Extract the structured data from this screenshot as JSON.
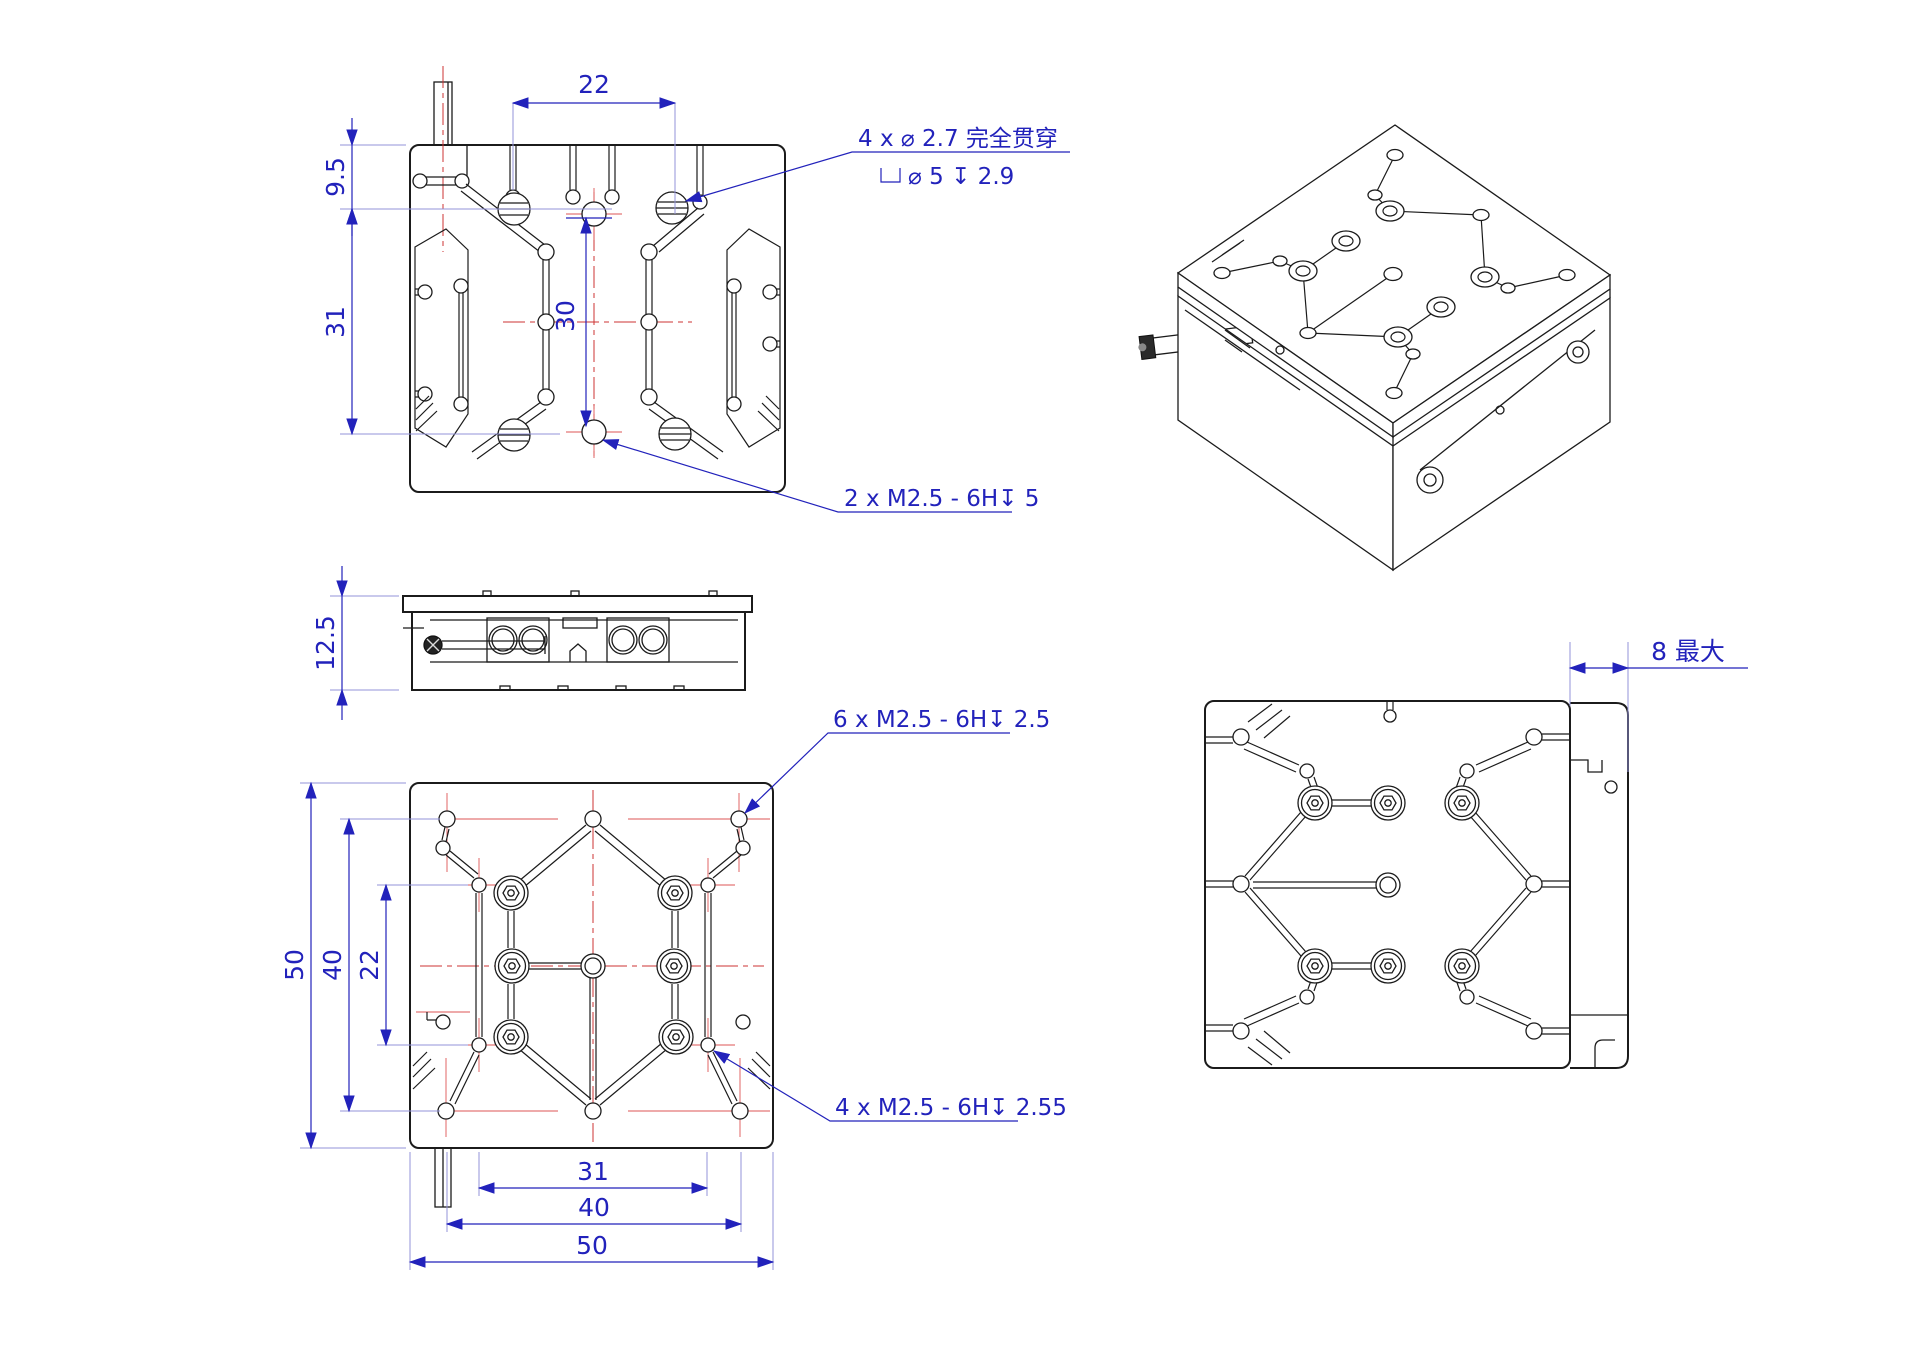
{
  "drawing_type": "engineering-drawing",
  "colors": {
    "background": "#ffffff",
    "line": "#1b1b1b",
    "dimension": "#2222bb",
    "centerline": "#cc3333"
  },
  "icons": {
    "counterbore": "⌴",
    "depth": "↧",
    "diameter": "⌀"
  },
  "views": {
    "top": {
      "dims": {
        "width": "22",
        "offset": "9.5",
        "span": "31",
        "inner": "30"
      },
      "notes": {
        "holes_line1": "4 x ⌀ 2.7 完全贯穿",
        "holes_line2": "⌀ 5 ↧ 2.9",
        "tap": "2 x M2.5 - 6H↧ 5"
      }
    },
    "side": {
      "dims": {
        "height": "12.5"
      }
    },
    "bottom": {
      "dims": {
        "left_outer": "50",
        "left_mid": "40",
        "left_inner": "22",
        "bottom_inner": "31",
        "bottom_mid": "40",
        "bottom_outer": "50"
      },
      "notes": {
        "tap_six": "6 x M2.5 - 6H↧ 2.5",
        "tap_four": "4 x M2.5 - 6H↧ 2.55"
      }
    },
    "travel": {
      "dims": {
        "travel": "8 最大"
      }
    }
  }
}
